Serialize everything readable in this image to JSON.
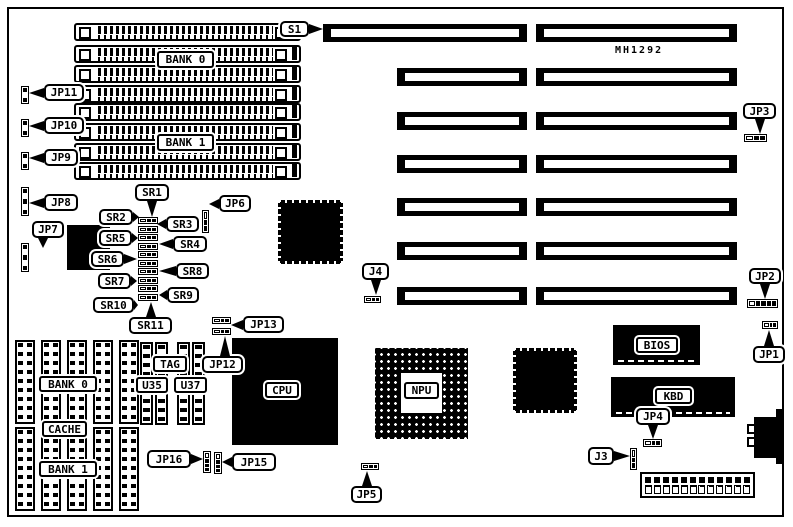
{
  "note": {
    "text": "MH1292",
    "x": 615,
    "y": 45
  },
  "board": {
    "frame": {
      "x": 7,
      "y": 7,
      "w": 777,
      "h": 510
    },
    "ink": "#000000",
    "paper": "#ffffff"
  },
  "simm": {
    "x": 74,
    "w": 227,
    "h": 18,
    "ys": [
      23,
      45,
      65,
      85,
      103,
      123,
      143,
      162
    ]
  },
  "slots": {
    "h": 18,
    "first": {
      "x": 323,
      "y": 24,
      "w": 204
    },
    "left": {
      "x": 397,
      "w": 130,
      "ys": [
        68,
        112,
        155,
        198,
        242,
        287
      ]
    },
    "right": {
      "x": 536,
      "w": 201,
      "ys": [
        24,
        68,
        112,
        155,
        198,
        242,
        287
      ]
    }
  },
  "chips": {
    "cpu": {
      "label": "CPU",
      "x": 232,
      "y": 338,
      "w": 106,
      "h": 107,
      "lb": {
        "x": 265,
        "y": 382,
        "w": 34,
        "h": 16
      }
    },
    "npu": {
      "label": "NPU",
      "x": 375,
      "y": 348,
      "w": 93,
      "h": 91,
      "center": {
        "x": 401,
        "y": 373,
        "w": 41,
        "h": 40
      },
      "lb": {
        "x": 404,
        "y": 382,
        "w": 35,
        "h": 17
      }
    },
    "bios": {
      "label": "BIOS",
      "x": 613,
      "y": 325,
      "w": 87,
      "h": 40,
      "lb": {
        "x": 636,
        "y": 337,
        "w": 42,
        "h": 16
      }
    },
    "kbd": {
      "label": "KBD",
      "x": 611,
      "y": 377,
      "w": 124,
      "h": 40,
      "lb": {
        "x": 655,
        "y": 388,
        "w": 37,
        "h": 16
      }
    },
    "qfp": [
      {
        "x": 278,
        "y": 200,
        "w": 65,
        "h": 64
      },
      {
        "x": 513,
        "y": 348,
        "w": 64,
        "h": 65
      }
    ],
    "solid": [
      {
        "x": 67,
        "y": 225,
        "w": 43,
        "h": 45
      }
    ]
  },
  "cache": {
    "cols": [
      15,
      41,
      67,
      93,
      119
    ],
    "rows": [
      340,
      427
    ],
    "w": 20,
    "h": 84
  },
  "tag_sockets": [
    {
      "x": 140,
      "y": 342,
      "w": 13,
      "h": 83
    },
    {
      "x": 155,
      "y": 342,
      "w": 13,
      "h": 83
    },
    {
      "x": 177,
      "y": 342,
      "w": 13,
      "h": 83
    },
    {
      "x": 192,
      "y": 342,
      "w": 13,
      "h": 83
    }
  ],
  "labels": [
    {
      "label": "BANK 0",
      "x": 157,
      "y": 51,
      "w": 57,
      "h": 17
    },
    {
      "label": "BANK 1",
      "x": 157,
      "y": 134,
      "w": 57,
      "h": 17
    },
    {
      "label": "BANK 0",
      "x": 39,
      "y": 376,
      "w": 58,
      "h": 16
    },
    {
      "label": "CACHE",
      "x": 42,
      "y": 421,
      "w": 45,
      "h": 16
    },
    {
      "label": "BANK 1",
      "x": 39,
      "y": 461,
      "w": 58,
      "h": 16
    },
    {
      "label": "TAG",
      "x": 153,
      "y": 356,
      "w": 34,
      "h": 16
    },
    {
      "label": "U35",
      "x": 136,
      "y": 377,
      "w": 32,
      "h": 16
    },
    {
      "label": "U37",
      "x": 174,
      "y": 377,
      "w": 33,
      "h": 16
    }
  ],
  "sr_column": {
    "x": 138,
    "w": 20,
    "h": 7,
    "cells": "obb",
    "ys": [
      217,
      226,
      234,
      243,
      251,
      260,
      268,
      277,
      285,
      294
    ]
  },
  "jumpers": [
    {
      "id": "jp11",
      "x": 21,
      "y": 86,
      "w": 8,
      "h": 18,
      "o": "v",
      "cells": "bwb"
    },
    {
      "id": "jp10",
      "x": 21,
      "y": 119,
      "w": 8,
      "h": 18,
      "o": "v",
      "cells": "bwb"
    },
    {
      "id": "jp9",
      "x": 21,
      "y": 152,
      "w": 8,
      "h": 18,
      "o": "v",
      "cells": "bwb"
    },
    {
      "id": "jp8",
      "x": 21,
      "y": 187,
      "w": 8,
      "h": 29,
      "o": "v",
      "cells": "bwbwb"
    },
    {
      "id": "jp7",
      "x": 21,
      "y": 243,
      "w": 8,
      "h": 29,
      "o": "v",
      "cells": "bwbwb"
    },
    {
      "id": "jp6",
      "x": 202,
      "y": 210,
      "w": 7,
      "h": 23,
      "o": "v",
      "cells": "obb"
    },
    {
      "id": "jp13",
      "x": 212,
      "y": 317,
      "w": 19,
      "h": 7,
      "o": "h",
      "cells": "obb"
    },
    {
      "id": "jp12",
      "x": 212,
      "y": 328,
      "w": 19,
      "h": 7,
      "o": "h",
      "cells": "obb"
    },
    {
      "id": "j4",
      "x": 364,
      "y": 296,
      "w": 17,
      "h": 7,
      "o": "h",
      "cells": "obb"
    },
    {
      "id": "jp5",
      "x": 361,
      "y": 463,
      "w": 18,
      "h": 7,
      "o": "h",
      "cells": "obb"
    },
    {
      "id": "jp16",
      "x": 203,
      "y": 451,
      "w": 8,
      "h": 22,
      "o": "v",
      "cells": "obbb"
    },
    {
      "id": "jp15",
      "x": 214,
      "y": 452,
      "w": 8,
      "h": 22,
      "o": "v",
      "cells": "obbb"
    },
    {
      "id": "jp4",
      "x": 643,
      "y": 439,
      "w": 19,
      "h": 8,
      "o": "h",
      "cells": "obb"
    },
    {
      "id": "j3",
      "x": 630,
      "y": 448,
      "w": 7,
      "h": 22,
      "o": "v",
      "cells": "obb"
    },
    {
      "id": "jp3",
      "x": 744,
      "y": 134,
      "w": 23,
      "h": 8,
      "o": "h",
      "cells": "obb"
    },
    {
      "id": "jp2",
      "x": 747,
      "y": 299,
      "w": 31,
      "h": 9,
      "o": "h",
      "cells": "obbbb"
    },
    {
      "id": "jp1",
      "x": 762,
      "y": 321,
      "w": 16,
      "h": 8,
      "o": "h",
      "cells": "obb"
    }
  ],
  "callouts": [
    {
      "label": "S1",
      "x": 280,
      "y": 21,
      "w": 29,
      "h": 16,
      "tail": {
        "side": "right",
        "len": 14
      }
    },
    {
      "label": "JP11",
      "x": 44,
      "y": 84,
      "w": 40,
      "h": 17,
      "tail": {
        "side": "left",
        "len": 15
      }
    },
    {
      "label": "JP10",
      "x": 44,
      "y": 117,
      "w": 40,
      "h": 17,
      "tail": {
        "side": "left",
        "len": 15
      }
    },
    {
      "label": "JP9",
      "x": 44,
      "y": 149,
      "w": 34,
      "h": 17,
      "tail": {
        "side": "left",
        "len": 15
      }
    },
    {
      "label": "JP8",
      "x": 44,
      "y": 194,
      "w": 34,
      "h": 17,
      "tail": {
        "side": "left",
        "len": 15
      }
    },
    {
      "label": "JP7",
      "x": 32,
      "y": 221,
      "w": 32,
      "h": 17,
      "tail": {
        "side": "bottom",
        "len": 10,
        "at": 4
      }
    },
    {
      "label": "JP6",
      "x": 219,
      "y": 195,
      "w": 32,
      "h": 17,
      "tail": {
        "side": "left",
        "len": 10
      }
    },
    {
      "label": "SR1",
      "x": 135,
      "y": 184,
      "w": 34,
      "h": 17,
      "tail": {
        "side": "bottom",
        "len": 16
      }
    },
    {
      "label": "SR2",
      "x": 99,
      "y": 209,
      "w": 34,
      "h": 16,
      "tail": {
        "side": "right",
        "len": 6
      }
    },
    {
      "label": "SR3",
      "x": 166,
      "y": 216,
      "w": 33,
      "h": 16,
      "tail": {
        "side": "left",
        "len": 9
      }
    },
    {
      "label": "SR5",
      "x": 99,
      "y": 230,
      "w": 33,
      "h": 16,
      "tail": {
        "side": "right",
        "len": 6
      }
    },
    {
      "label": "SR4",
      "x": 173,
      "y": 236,
      "w": 34,
      "h": 16,
      "tail": {
        "side": "left",
        "len": 14
      }
    },
    {
      "label": "SR6",
      "x": 91,
      "y": 251,
      "w": 33,
      "h": 16,
      "tail": {
        "side": "right",
        "len": 13
      }
    },
    {
      "label": "SR8",
      "x": 176,
      "y": 263,
      "w": 33,
      "h": 16,
      "tail": {
        "side": "left",
        "len": 17
      }
    },
    {
      "label": "SR7",
      "x": 98,
      "y": 273,
      "w": 33,
      "h": 16,
      "tail": {
        "side": "right",
        "len": 6
      }
    },
    {
      "label": "SR9",
      "x": 167,
      "y": 287,
      "w": 32,
      "h": 16,
      "tail": {
        "side": "left",
        "len": 8
      }
    },
    {
      "label": "SR10",
      "x": 93,
      "y": 297,
      "w": 41,
      "h": 16,
      "tail": {
        "side": "right",
        "len": 4
      }
    },
    {
      "label": "SR11",
      "x": 129,
      "y": 317,
      "w": 43,
      "h": 17,
      "tail": {
        "side": "top",
        "len": 15
      }
    },
    {
      "label": "JP13",
      "x": 243,
      "y": 316,
      "w": 41,
      "h": 17,
      "tail": {
        "side": "left",
        "len": 12
      }
    },
    {
      "label": "JP12",
      "x": 202,
      "y": 356,
      "w": 41,
      "h": 17,
      "tail": {
        "side": "top",
        "len": 20,
        "at": 16
      }
    },
    {
      "label": "J4",
      "x": 362,
      "y": 263,
      "w": 27,
      "h": 17,
      "tail": {
        "side": "bottom",
        "len": 15
      }
    },
    {
      "label": "JP16",
      "x": 147,
      "y": 450,
      "w": 44,
      "h": 18,
      "tail": {
        "side": "right",
        "len": 12
      }
    },
    {
      "label": "JP15",
      "x": 232,
      "y": 453,
      "w": 44,
      "h": 18,
      "tail": {
        "side": "left",
        "len": 10
      }
    },
    {
      "label": "JP5",
      "x": 351,
      "y": 486,
      "w": 31,
      "h": 17,
      "tail": {
        "side": "top",
        "len": 15
      }
    },
    {
      "label": "JP3",
      "x": 743,
      "y": 103,
      "w": 33,
      "h": 16,
      "tail": {
        "side": "bottom",
        "len": 15
      }
    },
    {
      "label": "JP2",
      "x": 749,
      "y": 268,
      "w": 32,
      "h": 16,
      "tail": {
        "side": "bottom",
        "len": 15
      }
    },
    {
      "label": "JP1",
      "x": 753,
      "y": 346,
      "w": 32,
      "h": 17,
      "tail": {
        "side": "top",
        "len": 16
      }
    },
    {
      "label": "JP4",
      "x": 636,
      "y": 408,
      "w": 34,
      "h": 17,
      "tail": {
        "side": "bottom",
        "len": 14
      }
    },
    {
      "label": "J3",
      "x": 588,
      "y": 447,
      "w": 26,
      "h": 18,
      "tail": {
        "side": "right",
        "len": 16
      }
    }
  ],
  "power": {
    "x": 640,
    "y": 472,
    "w": 115,
    "h": 26,
    "pins": 12
  },
  "din": {
    "main": {
      "x": 754,
      "y": 417,
      "w": 30,
      "h": 41
    },
    "steps": [
      {
        "x": 776,
        "y": 409,
        "w": 8,
        "h": 9
      },
      {
        "x": 776,
        "y": 456,
        "w": 8,
        "h": 8
      }
    ],
    "tabs": [
      {
        "x": 747,
        "y": 424,
        "w": 9,
        "h": 10
      },
      {
        "x": 747,
        "y": 437,
        "w": 9,
        "h": 10
      }
    ]
  }
}
